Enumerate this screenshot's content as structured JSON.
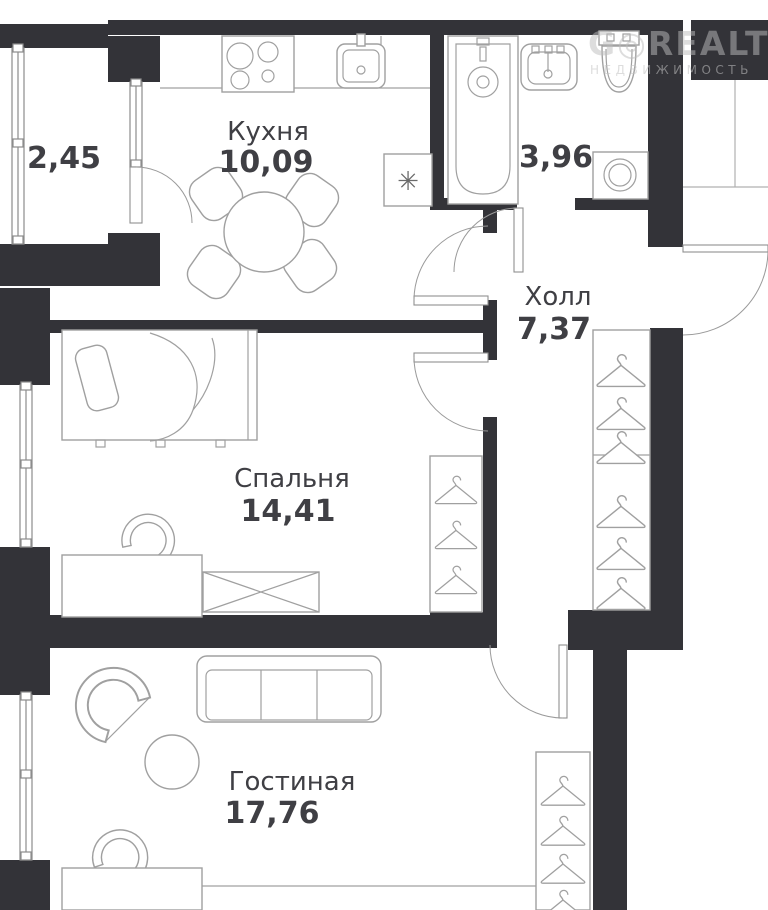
{
  "watermark": {
    "brand": "G◎REALT",
    "subtitle": "НЕДВИЖИМОСТЬ"
  },
  "rooms": {
    "balcony": {
      "area": "2,45"
    },
    "kitchen": {
      "name": "Кухня",
      "area": "10,09"
    },
    "bathroom": {
      "area": "3,96"
    },
    "hall": {
      "name": "Холл",
      "area": "7,37"
    },
    "bedroom": {
      "name": "Спальня",
      "area": "14,41"
    },
    "living": {
      "name": "Гостиная",
      "area": "17,76"
    }
  },
  "symbols": {
    "vent": "✳"
  },
  "colors": {
    "wall": "#333338",
    "outline": "#a0a0a0",
    "label": "#3f3f44",
    "background": "#ffffff"
  }
}
